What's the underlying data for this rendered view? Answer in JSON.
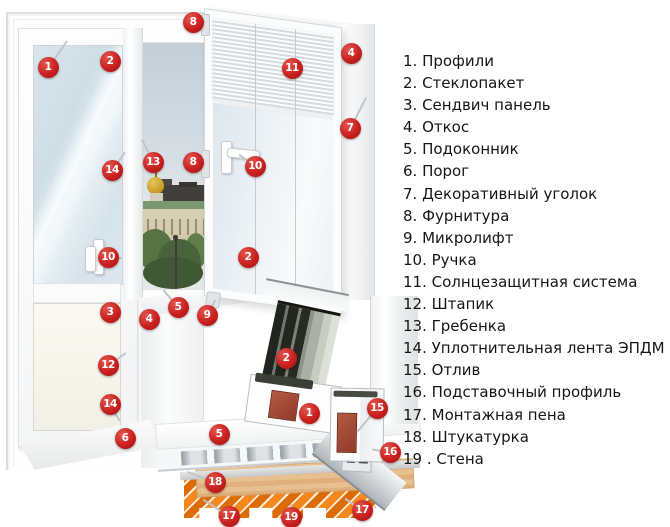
{
  "legend": {
    "items": [
      "1. Профили",
      "2. Стеклопакет",
      "3. Сендвич панель",
      "4. Откос",
      "5. Подоконник",
      "6. Порог",
      "7. Декоративный уголок",
      "8. Фурнитура",
      "9. Микролифт",
      "10. Ручка",
      "11. Солнцезащитная система",
      "12. Штапик",
      "13. Гребенка",
      "14. Уплотнительная лента ЭПДМ",
      "15. Отлив",
      "16. Подставочный профиль",
      "17. Монтажная пена",
      "18. Штукатурка",
      "19 . Стена"
    ]
  },
  "markers": [
    {
      "label": "1",
      "name": "profiles",
      "x": 48,
      "y": 67
    },
    {
      "label": "2",
      "name": "glazing-unit",
      "x": 110,
      "y": 61
    },
    {
      "label": "8",
      "name": "hardware-top",
      "x": 193,
      "y": 22
    },
    {
      "label": "11",
      "name": "sun-protection",
      "x": 292,
      "y": 68
    },
    {
      "label": "4",
      "name": "slope-top",
      "x": 351,
      "y": 53
    },
    {
      "label": "7",
      "name": "decorative-corner",
      "x": 350,
      "y": 128
    },
    {
      "label": "13",
      "name": "comb",
      "x": 153,
      "y": 162
    },
    {
      "label": "8",
      "name": "hardware-middle",
      "x": 193,
      "y": 162
    },
    {
      "label": "14",
      "name": "epdm-seal-top",
      "x": 112,
      "y": 170
    },
    {
      "label": "10",
      "name": "sash-handle",
      "x": 255,
      "y": 166
    },
    {
      "label": "2",
      "name": "sash-glazing",
      "x": 248,
      "y": 257
    },
    {
      "label": "10",
      "name": "door-handle",
      "x": 108,
      "y": 257
    },
    {
      "label": "5",
      "name": "window-sill",
      "x": 178,
      "y": 307
    },
    {
      "label": "9",
      "name": "microlift",
      "x": 207,
      "y": 315
    },
    {
      "label": "3",
      "name": "sandwich-panel",
      "x": 110,
      "y": 312
    },
    {
      "label": "4",
      "name": "slope-side",
      "x": 149,
      "y": 319
    },
    {
      "label": "12",
      "name": "glazing-bead",
      "x": 108,
      "y": 365
    },
    {
      "label": "14",
      "name": "epdm-seal-bottom",
      "x": 110,
      "y": 404
    },
    {
      "label": "6",
      "name": "threshold",
      "x": 125,
      "y": 438
    },
    {
      "label": "5",
      "name": "sill-section",
      "x": 219,
      "y": 434
    },
    {
      "label": "2",
      "name": "glazing-section",
      "x": 286,
      "y": 358
    },
    {
      "label": "1",
      "name": "profile-section",
      "x": 309,
      "y": 413
    },
    {
      "label": "15",
      "name": "drip-sill",
      "x": 377,
      "y": 408
    },
    {
      "label": "16",
      "name": "support-profile",
      "x": 390,
      "y": 452
    },
    {
      "label": "18",
      "name": "plaster",
      "x": 215,
      "y": 482
    },
    {
      "label": "17",
      "name": "mounting-foam-left",
      "x": 229,
      "y": 516
    },
    {
      "label": "19",
      "name": "wall",
      "x": 291,
      "y": 517
    },
    {
      "label": "17",
      "name": "mounting-foam-right",
      "x": 362,
      "y": 510
    }
  ],
  "colors": {
    "marker_red": "#c41e22",
    "wall_orange": "#ef7d12",
    "wall_stripe_dark": "#dd6c06",
    "foam_tan": "#e2b382",
    "plaster_gray": "#d0d3d5",
    "drip_gray": "#b6bcc1",
    "door_glass_blue": "#d7e4eb",
    "tree_green": "#55703f",
    "dome_gold": "#d2a72e",
    "palace_cream": "#d5cbae"
  }
}
